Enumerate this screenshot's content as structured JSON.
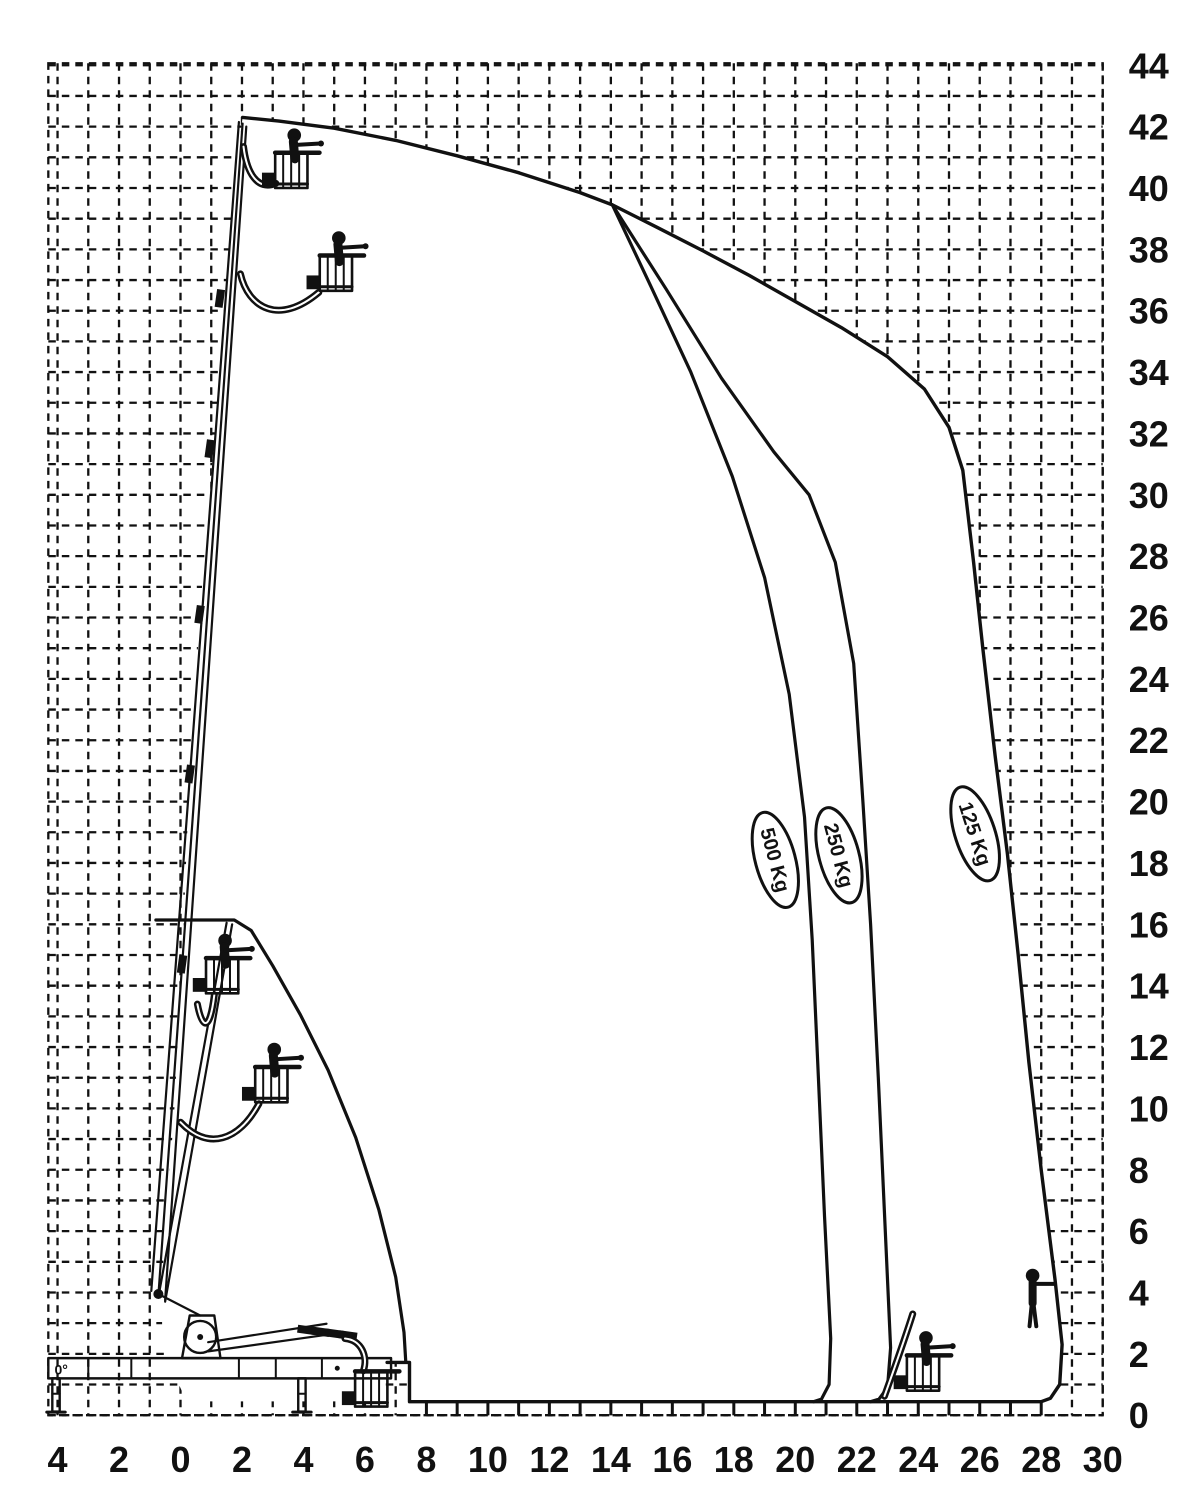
{
  "page": {
    "background": "#ffffff",
    "ink_color": "#111111",
    "description": "Aerial work platform working-range load diagram (height vs outreach, metres)"
  },
  "chart_data": {
    "type": "line",
    "title": "",
    "xlabel": "",
    "ylabel": "",
    "units": "m",
    "grid": {
      "step": 1,
      "style": "dashed",
      "visible_outside_envelope_only": true
    },
    "x_axis": {
      "range": [
        -4.3,
        30
      ],
      "tick_values": [
        -4,
        -2,
        0,
        2,
        4,
        6,
        8,
        10,
        12,
        14,
        16,
        18,
        20,
        22,
        24,
        26,
        28,
        30
      ],
      "tick_labels": [
        "4",
        "2",
        "0",
        "2",
        "4",
        "6",
        "8",
        "10",
        "12",
        "14",
        "16",
        "18",
        "20",
        "22",
        "24",
        "26",
        "28",
        "30"
      ]
    },
    "y_axis": {
      "range": [
        0,
        44
      ],
      "tick_values": [
        0,
        2,
        4,
        6,
        8,
        10,
        12,
        14,
        16,
        18,
        20,
        22,
        24,
        26,
        28,
        30,
        32,
        34,
        36,
        38,
        40,
        42,
        44
      ],
      "tick_labels": [
        "0",
        "2",
        "4",
        "6",
        "8",
        "10",
        "12",
        "14",
        "16",
        "18",
        "20",
        "22",
        "24",
        "26",
        "28",
        "30",
        "32",
        "34",
        "36",
        "38",
        "40",
        "42",
        "44"
      ],
      "position": "right"
    },
    "envelope_outline": {
      "name": "125 Kg outer working envelope",
      "points": [
        [
          2.02,
          42.3
        ],
        [
          3.2,
          42.18
        ],
        [
          5,
          41.95
        ],
        [
          7,
          41.55
        ],
        [
          9,
          41.05
        ],
        [
          11,
          40.5
        ],
        [
          13,
          39.85
        ],
        [
          14.05,
          39.45
        ],
        [
          15.5,
          38.72
        ],
        [
          17,
          37.95
        ],
        [
          18.5,
          37.15
        ],
        [
          20,
          36.3
        ],
        [
          21.5,
          35.45
        ],
        [
          23,
          34.5
        ],
        [
          24.2,
          33.45
        ],
        [
          25.0,
          32.2
        ],
        [
          25.45,
          30.8
        ],
        [
          25.8,
          27.8
        ],
        [
          26.1,
          25.0
        ],
        [
          26.5,
          21.5
        ],
        [
          26.9,
          18.3
        ],
        [
          27.25,
          15.0
        ],
        [
          27.6,
          11.5
        ],
        [
          28.0,
          8.0
        ],
        [
          28.45,
          4.4
        ],
        [
          28.68,
          2.3
        ],
        [
          28.6,
          1.0
        ],
        [
          28.3,
          0.55
        ],
        [
          28.0,
          0.44
        ],
        [
          7.45,
          0.44
        ],
        [
          7.45,
          1.72
        ],
        [
          6.72,
          1.72
        ]
      ]
    },
    "envelope_left_edge": {
      "points": [
        [
          2.02,
          42.3
        ],
        [
          1.85,
          41.0
        ],
        [
          1.6,
          38.0
        ],
        [
          1.2,
          33.0
        ],
        [
          0.7,
          27.0
        ],
        [
          0.3,
          21.0
        ],
        [
          0.1,
          16.0
        ],
        [
          -0.2,
          10.0
        ],
        [
          -0.6,
          4.5
        ],
        [
          -0.6,
          2.2
        ],
        [
          0.2,
          0.45
        ],
        [
          6.35,
          0.45
        ],
        [
          6.5,
          0.9
        ],
        [
          6.72,
          1.72
        ]
      ]
    },
    "envelope_inner": {
      "name": "boom-only envelope",
      "points": [
        [
          -0.8,
          16.14
        ],
        [
          1.75,
          16.14
        ],
        [
          2.3,
          15.8
        ],
        [
          3.0,
          14.65
        ],
        [
          3.9,
          13.05
        ],
        [
          4.8,
          11.25
        ],
        [
          5.7,
          9.05
        ],
        [
          6.45,
          6.7
        ],
        [
          7.0,
          4.5
        ],
        [
          7.27,
          2.7
        ],
        [
          7.33,
          1.72
        ]
      ]
    },
    "curves": [
      {
        "name": "500 Kg limit",
        "points": [
          [
            14.05,
            39.45
          ],
          [
            15.3,
            36.8
          ],
          [
            16.6,
            34.0
          ],
          [
            17.95,
            30.6
          ],
          [
            19.0,
            27.3
          ],
          [
            19.8,
            23.5
          ],
          [
            20.3,
            19.5
          ],
          [
            20.55,
            15.5
          ],
          [
            20.75,
            11.0
          ],
          [
            20.95,
            6.5
          ],
          [
            21.15,
            2.5
          ],
          [
            21.1,
            1.0
          ],
          [
            20.85,
            0.52
          ],
          [
            20.6,
            0.44
          ]
        ]
      },
      {
        "name": "250 Kg limit",
        "points": [
          [
            14.05,
            39.45
          ],
          [
            15.8,
            36.7
          ],
          [
            17.6,
            33.8
          ],
          [
            19.3,
            31.4
          ],
          [
            20.45,
            30.0
          ],
          [
            21.3,
            27.8
          ],
          [
            21.9,
            24.5
          ],
          [
            22.2,
            20.0
          ],
          [
            22.45,
            16.0
          ],
          [
            22.7,
            11.0
          ],
          [
            22.95,
            5.5
          ],
          [
            23.1,
            2.2
          ],
          [
            23.0,
            0.9
          ],
          [
            22.72,
            0.52
          ],
          [
            22.45,
            0.44
          ]
        ]
      }
    ],
    "load_labels": [
      {
        "text": "500 Kg",
        "x": 19.35,
        "y": 18.1,
        "tilt": -15
      },
      {
        "text": "250 Kg",
        "x": 21.42,
        "y": 18.25,
        "tilt": -15
      },
      {
        "text": "125 Kg",
        "x": 25.85,
        "y": 18.95,
        "tilt": -18
      }
    ],
    "bottom_ticks": {
      "from": 8,
      "to": 28,
      "step": 1
    },
    "machine": {
      "angle_label": "0°",
      "pivot": [
        -0.72,
        3.95
      ],
      "chassis": {
        "beam": [
          [
            -4.3,
            1.2
          ],
          [
            6.85,
            1.86
          ]
        ],
        "legs_x": [
          -4.05,
          3.95
        ]
      },
      "booms": [
        {
          "from": [
            -0.95,
            4.05
          ],
          "to": [
            1.9,
            42.15
          ]
        },
        {
          "from": [
            -0.72,
            3.9
          ],
          "to": [
            2.02,
            42.1
          ]
        },
        {
          "from": [
            -0.5,
            3.75
          ],
          "to": [
            2.14,
            42.0
          ]
        },
        {
          "from": [
            -0.72,
            3.85
          ],
          "to": [
            1.5,
            16.05
          ]
        },
        {
          "from": [
            -0.5,
            3.7
          ],
          "to": [
            1.68,
            16.0
          ]
        },
        {
          "from": [
            0.9,
            2.08
          ],
          "to": [
            4.75,
            2.62
          ]
        },
        {
          "from": [
            0.9,
            2.38
          ],
          "to": [
            4.75,
            2.98
          ]
        }
      ],
      "collars": [
        {
          "x": 1.28,
          "y": 36.4,
          "angle": -82
        },
        {
          "x": 0.95,
          "y": 31.5,
          "angle": -82
        },
        {
          "x": 0.62,
          "y": 26.1,
          "angle": -82
        },
        {
          "x": 0.3,
          "y": 20.9,
          "angle": -82
        },
        {
          "x": 0.05,
          "y": 14.7,
          "angle": -82
        },
        {
          "x": 4.1,
          "y": 2.78,
          "angle": 8
        },
        {
          "x": 4.55,
          "y": 2.72,
          "angle": 8
        },
        {
          "x": 5.0,
          "y": 2.66,
          "angle": 8
        },
        {
          "x": 5.45,
          "y": 2.6,
          "angle": 8
        }
      ],
      "jibs": [
        [
          [
            2.05,
            41.35
          ],
          [
            2.15,
            40.5
          ],
          [
            2.5,
            39.9
          ],
          [
            3.1,
            40.15
          ]
        ],
        [
          [
            1.95,
            37.2
          ],
          [
            2.2,
            36.1
          ],
          [
            3.2,
            35.5
          ],
          [
            4.5,
            36.6
          ]
        ],
        [
          [
            0.55,
            13.4
          ],
          [
            0.7,
            12.6
          ],
          [
            0.95,
            12.45
          ],
          [
            1.1,
            13.7
          ]
        ],
        [
          [
            0.0,
            9.55
          ],
          [
            0.9,
            8.6
          ],
          [
            1.9,
            8.95
          ],
          [
            2.55,
            10.15
          ]
        ],
        [
          [
            5.35,
            2.5
          ],
          [
            5.9,
            2.45
          ],
          [
            6.1,
            1.9
          ],
          [
            5.95,
            1.45
          ]
        ],
        [
          [
            22.9,
            0.62
          ],
          [
            23.25,
            1.6
          ],
          [
            23.6,
            2.6
          ],
          [
            23.82,
            3.3
          ]
        ]
      ],
      "baskets": [
        {
          "x": 3.6,
          "bottom": 40.0,
          "operator": true,
          "name": "platform-max-height"
        },
        {
          "x": 5.05,
          "bottom": 36.65,
          "operator": true,
          "name": "platform-articulated-high"
        },
        {
          "x": 1.35,
          "bottom": 13.75,
          "operator": true,
          "name": "platform-mid"
        },
        {
          "x": 2.95,
          "bottom": 10.2,
          "operator": true,
          "name": "platform-mid-low"
        },
        {
          "x": 6.2,
          "bottom": 0.28,
          "operator": false,
          "name": "platform-stowed"
        },
        {
          "x": 24.15,
          "bottom": 0.8,
          "operator": true,
          "name": "platform-max-outreach"
        }
      ],
      "persons": [
        {
          "x": 27.72,
          "feet": 2.9,
          "name": "person-at-max-reach"
        }
      ]
    }
  }
}
